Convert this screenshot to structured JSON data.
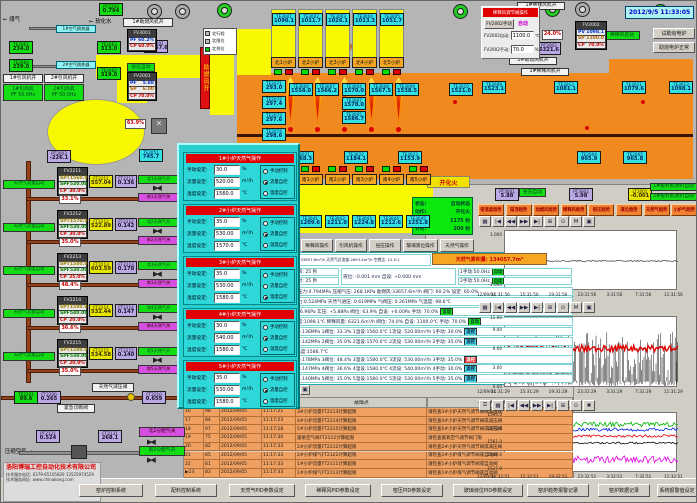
{
  "header": {
    "datetime": "2012/9/5 11:33:05"
  },
  "colors": {
    "furnace_orange": "#f08a1e",
    "duct_yellow": "#f8f800",
    "panel_cyan": "#27cfcf",
    "alarm_orange": "#f0a060",
    "pipe_brown": "#93401b",
    "status_green": "#0be80b",
    "alarm_red": "#e00000"
  },
  "ignite_label": "开化火",
  "accumulator": "天然气累积量: 134057.7m³",
  "company": {
    "name": "洛阳博瑞工控自动化技术有限公司",
    "phone": "技术服务电话: 0379-65105829  13525974529",
    "site": "技术服务网址: www.chinakong.com"
  },
  "status_box": {
    "rows": [
      [
        "状态:",
        "自动状态"
      ],
      [
        "动作:",
        "开化火"
      ],
      [
        "设定:",
        "1175 秒"
      ],
      [
        "计时:",
        "200 秒"
      ]
    ]
  },
  "legend": {
    "items": [
      {
        "color": "#c0c0c0",
        "text": "北行程"
      },
      {
        "color": "#c0c0c0",
        "text": "北限位"
      },
      {
        "color": "#00c000",
        "text": "北到位"
      }
    ]
  },
  "dilution_panel": {
    "title": "稀释风调节阀操作",
    "manual_button": "FV2002手动",
    "auto_label": "自动",
    "fields": [
      {
        "label": "FV2002自动:",
        "value": "1100.0",
        "unit": "℃"
      },
      {
        "label": "FV2002手动:",
        "value": "70.0",
        "unit": "%"
      }
    ]
  },
  "north_furnaces": [
    "北1小炉",
    "北2小炉",
    "北3小炉",
    "北4小炉",
    "北5小炉"
  ],
  "south_furnaces": [
    "南1小炉",
    "南2小炉",
    "南3小炉",
    "南4小炉",
    "南5小炉"
  ],
  "sensors": [
    {
      "id": "PT2202",
      "value": "0.794"
    },
    {
      "id": "TE2061",
      "value": "234.0"
    },
    {
      "id": "TE2064",
      "value": "239.0"
    },
    {
      "id": "TE2063",
      "value": "313.0"
    },
    {
      "id": "TE2062",
      "value": "319.0"
    },
    {
      "id": "FT2001",
      "value": "33657.6"
    },
    {
      "id": "PT2003",
      "value": "-226.1"
    },
    {
      "id": "TE2051",
      "value": "745.7"
    },
    {
      "id": "TE3001",
      "value": "1090.1"
    },
    {
      "id": "TE3002",
      "value": "1011.7"
    },
    {
      "id": "TE3003",
      "value": "1026.1"
    },
    {
      "id": "TE3004",
      "value": "1013.3"
    },
    {
      "id": "TE3005",
      "value": "1051.7"
    },
    {
      "id": "TE2071",
      "value": "293.0"
    },
    {
      "id": "TE2072",
      "value": "297.4"
    },
    {
      "id": "TE2073",
      "value": "297.6"
    },
    {
      "id": "TE2074",
      "value": "298.6"
    },
    {
      "id": "TE2075",
      "value": "298.6"
    },
    {
      "id": "TE3006",
      "value": "1558.0"
    },
    {
      "id": "TE3007",
      "value": "1566.2"
    },
    {
      "id": "TE3004",
      "value": "1570.0"
    },
    {
      "id": "TE3007",
      "value": "1578.0"
    },
    {
      "id": "TE3005",
      "value": "1586.7"
    },
    {
      "id": "TE3008",
      "value": "1567.5"
    },
    {
      "id": "TE3009",
      "value": "1538.5"
    },
    {
      "id": "TE3010",
      "value": "1521.0"
    },
    {
      "id": "TE3021",
      "value": "1168.3"
    },
    {
      "id": "TE3022",
      "value": "1184.1"
    },
    {
      "id": "TE3023",
      "value": "1153.9"
    },
    {
      "id": "TE2009",
      "value": "1523.1"
    },
    {
      "id": "TE3012",
      "value": "1081.1"
    },
    {
      "id": "TE3011",
      "value": "1079.6"
    },
    {
      "id": "TE3013",
      "value": "1098.1"
    },
    {
      "id": "TE2004",
      "value": "965.9"
    },
    {
      "id": "TE2005",
      "value": "965.8"
    },
    {
      "id": "TE3041",
      "value": "1209.6"
    },
    {
      "id": "TE3042",
      "value": "1211.0"
    },
    {
      "id": "TE3043",
      "value": "1224.8"
    },
    {
      "id": "TE3044",
      "value": "1212.6"
    },
    {
      "id": "TE3045",
      "value": "1251.8"
    },
    {
      "id": "PT3001",
      "value": "5.88"
    },
    {
      "id": "PT3002",
      "value": "5.98"
    },
    {
      "id": "LT2001",
      "value": "-0.001"
    },
    {
      "id": "PT2002",
      "value": "6321.6"
    },
    {
      "id": "TE2201",
      "value": "99.6"
    },
    {
      "id": "FT2200",
      "value": "0.265"
    },
    {
      "id": "FT2210",
      "value": "0.659"
    },
    {
      "id": "PT2121",
      "value": "0.524"
    },
    {
      "id": "FT2131",
      "value": "268.1"
    }
  ],
  "labels": [
    {
      "text": "← 煤气"
    },
    {
      "text": "← 软化水"
    },
    {
      "text": "1#空气换热器"
    },
    {
      "text": "2#空气换热器"
    },
    {
      "text": "1#引风机开"
    },
    {
      "text": "2#引风机开"
    },
    {
      "text": "1#助燃风机开"
    },
    {
      "text": "窑压自动"
    },
    {
      "text": "助燃风开"
    },
    {
      "text": "烟囱"
    },
    {
      "text": "蓄热室"
    },
    {
      "text": "蓄热室"
    },
    {
      "text": "1#稀释风机开"
    },
    {
      "text": "2#助燃风机开"
    },
    {
      "text": "1#稀释风机开"
    },
    {
      "text": "稀释风启动"
    },
    {
      "text": "窑压自动"
    },
    {
      "text": "1#投料机进料自动"
    },
    {
      "text": "2#投料机进料自动"
    },
    {
      "text": "天然气减压阀"
    },
    {
      "text": "紧急切断阀"
    },
    {
      "text": "北2分配气关"
    },
    {
      "text": "南2分配气开"
    },
    {
      "text": "压缩空气 →"
    },
    {
      "text": "63.9%"
    },
    {
      "text": "24.0%"
    },
    {
      "text": "1#引风机\nPF 50.0Hz"
    },
    {
      "text": "2#引风机\nPF 50.0Hz"
    }
  ],
  "controllers": [
    {
      "id": "FV3001",
      "rows": [
        {
          "k": "PF",
          "v": "60.2%",
          "c": "v-blue"
        },
        {
          "k": "CP",
          "v": "60.0%",
          "c": "v-red"
        }
      ]
    },
    {
      "id": "FV2001",
      "rows": [
        {
          "k": "PF",
          "v": "5.88",
          "c": "v-blue"
        },
        {
          "k": "SP",
          "v": "6.00",
          "c": "v-orange"
        },
        {
          "k": "CP",
          "v": "70.0%",
          "c": "v-red"
        }
      ]
    },
    {
      "id": "FV2002",
      "rows": [
        {
          "k": "PV",
          "v": "1098.1",
          "c": "v-blue"
        },
        {
          "k": "SP",
          "v": "1100.0",
          "c": "v-orange"
        },
        {
          "k": "CP",
          "v": "70.0%",
          "c": "v-red"
        }
      ]
    }
  ],
  "fuel_controllers": [
    {
      "id": "FV2211",
      "spt": "1560.0",
      "spf": "520.00",
      "cp": "30.0%",
      "flow_id": "FT2211",
      "flow": "557.04",
      "press_id": "FT2211",
      "press": "0.136",
      "pos": "33.1%",
      "open": "北1天然气开",
      "close": "南1天然气关",
      "mode": "天然气流量自动"
    },
    {
      "id": "FV2212",
      "spt": "1570.0",
      "spf": "530.00",
      "cp": "30.0%",
      "flow_id": "FT2212",
      "flow": "522.89",
      "press_id": "FT2212",
      "press": "0.142",
      "pos": "35.0%",
      "open": "北2天然气开",
      "close": "南2天然气关",
      "mode": "天然气流量自动"
    },
    {
      "id": "FV2213",
      "spt": "1580.0",
      "spf": "530.00",
      "cp": "25.0%",
      "flow_id": "FT2213",
      "flow": "603.59",
      "press_id": "FT2213",
      "press": "0.178",
      "pos": "48.4%",
      "open": "北3天然气开",
      "close": "南3天然气关",
      "mode": "天然气温度自动"
    },
    {
      "id": "FV2214",
      "spt": "1580.0",
      "spf": "540.00",
      "cp": "20.0%",
      "flow_id": "FT2214",
      "flow": "532.44",
      "press_id": "FT2214",
      "press": "0.147",
      "pos": "36.6%",
      "open": "北4天然气开",
      "close": "南4天然气关",
      "mode": "天然气流量自动"
    },
    {
      "id": "FV2215",
      "spt": "1580.0",
      "spf": "530.00",
      "cp": "20.0%",
      "flow_id": "FT2215",
      "flow": "534.58",
      "press_id": "FT2215",
      "press": "0.140",
      "pos": "35.0%",
      "open": "北5天然气开",
      "close": "南5天然气关",
      "mode": "天然气流量自动"
    }
  ],
  "popup": {
    "labels": {
      "manual": "手动设定:",
      "flow": "流量设定:",
      "temp": "温度设定:",
      "units": [
        "%",
        "m³/h",
        "℃"
      ],
      "radios": [
        "手动控制",
        "流量自控",
        "温度自控"
      ]
    },
    "sections": [
      {
        "title": "1#小炉天然气操作",
        "manual": "30.0",
        "flow": "520.00",
        "temp": "1560.0",
        "selected": 1
      },
      {
        "title": "2#小炉天然气操作",
        "manual": "35.0",
        "flow": "530.00",
        "temp": "1570.0",
        "selected": 1
      },
      {
        "title": "3#小炉天然气操作",
        "manual": "35.0",
        "flow": "530.00",
        "temp": "1580.0",
        "selected": 2
      },
      {
        "title": "4#小炉天然气操作",
        "manual": "30.0",
        "flow": "540.00",
        "temp": "1580.0",
        "selected": 1
      },
      {
        "title": "5#小炉天然气操作",
        "manual": "35.0",
        "flow": "530.00",
        "temp": "1580.0",
        "selected": 1
      }
    ]
  },
  "buttons": {
    "trend": [
      "窑温度趋势",
      "碹顶趋势",
      "助燃风趋势",
      "稀释风趋势",
      "窑压趋势",
      "液位趋势",
      "天然气趋势",
      "小炉气趋势"
    ],
    "operate": [
      "稀释风操作",
      "引风机操作",
      "窑压操作",
      "玻璃液位操作",
      "天然气操作"
    ],
    "right": [
      "试助熔电炉",
      "助熔电炉正常"
    ],
    "bottom": [
      "窑炉控制系统",
      "配料控制系统",
      "天然气PID参数设定",
      "稀释风PID参数设定",
      "窑压PID参数设定",
      "玻璃液位PID参数设定",
      "窑炉趋势报警记录",
      "窑炉数据记录",
      "系统报警值设定"
    ]
  },
  "params": {
    "rowA": "助燃风量:33657.6m³/h 天然气总流量:2693.4m³/h 空燃比: 12.5:1",
    "switch_time": [
      "换火时间: 25 秒",
      "换火计时: 25 秒"
    ],
    "level": "液位: -0.001 mm    自设: +0.000 mm",
    "fans": [
      [
        "1手动:50.0Hz",
        "自动"
      ],
      [
        "2手动:50.0Hz",
        "自动"
      ]
    ],
    "lines": [
      {
        "t": "天然气压力:0.794MPa  压缩气压: 268.1KPa  助燃风:33657.6m³/h  阀门: 60.2%  设定: 60.0%",
        "chip": null
      },
      {
        "t": "煤气压力:0.524MPa  天然气进压: 0.619MPa  气阀压: 0.261MPa  气温度: 98.6℃",
        "chip": null
      },
      {
        "t": "窑压: +6.96Pa  实压: +5.88Pa  阀位: 63.9%  自设: +6.00Pa  手动: 70.0%",
        "chip": "自动"
      },
      {
        "t": "稀释温度:1098.1℃  稀释风量: 6321.6m³/h  阀位: 74.0%  自设: 1100.0℃  手动: 70.0%",
        "chip": "自动"
      },
      {
        "t": "1压力:0.136MPa  1阀位: 33.3%  1温设:1560.0℃  1流设: 520.00m³/h  1手动: 30.0%",
        "chip": "流控"
      },
      {
        "t": "2压力:0.142MPa  2阀位: 35.0%  2温设:1570.0℃  2流设: 530.00m³/h  2手动: 35.0%",
        "chip": "流控"
      },
      {
        "t": "3碹顶温度:1586.7℃",
        "chip": null
      },
      {
        "t": "3压力:0.178MPa  3阀位: 48.4%  3温设:1580.0℃  3流设: 530.00m³/h  3手动: 35.0%",
        "chip": "温控"
      },
      {
        "t": "4压力:0.147MPa  4阀位: 36.6%  4温设:1580.0℃  4流设: 540.00m³/h  4手动: 30.0%",
        "chip": "流控"
      },
      {
        "t": "5压力:0.140MPa  5阀位: 35.0%  5温设:1580.0℃  5流设: 530.00m³/h  5手动: 35.0%",
        "chip": "流控"
      }
    ]
  },
  "alarm_table": {
    "headers": [
      "故障点",
      "故障原因（供参考）"
    ],
    "selected_seq": "23",
    "rows": [
      {
        "seq": "16",
        "code": "98",
        "date": "2012/09/05",
        "time": "11:17:21",
        "fault": "3#小炉流量FT2213计算超限",
        "reason": "请检查3#小炉天然气调节阀或减压阀"
      },
      {
        "seq": "17",
        "code": "84",
        "date": "2012/09/05",
        "time": "11:17:23",
        "fault": "4#小炉流量FT2214计算超限",
        "reason": "请检查4#小炉天然气调节阀或减压阀"
      },
      {
        "seq": "18",
        "code": "97",
        "date": "2012/09/05",
        "time": "11:17:28",
        "fault": "5#小炉流量FT2215计算超限",
        "reason": "请检查5#小炉天然气调节阀或减压阀"
      },
      {
        "seq": "19",
        "code": "75",
        "date": "2012/09/05",
        "time": "11:17:30",
        "fault": "富氧空气阀FT2112计算超限",
        "reason": "请检查富氧空气调节阀门限"
      },
      {
        "seq": "20",
        "code": "82",
        "date": "2012/09/05",
        "time": "11:17:33",
        "fault": "2#小炉流量FT2212计算超限",
        "reason": "请检查2#小炉天然气调节阀或减压阀"
      },
      {
        "seq": "21",
        "code": "85",
        "date": "2012/09/05",
        "time": "11:17:33",
        "fault": "2#小炉煤气FT2122计算超限",
        "reason": "请检查2#小炉煤气调节阀或自动阀"
      },
      {
        "seq": "22",
        "code": "81",
        "date": "2012/09/05",
        "time": "11:17:33",
        "fault": "1#小炉流量FT2111计算超限",
        "reason": "请检查1#小炉煤气调节阀或自动阀"
      },
      {
        "seq": "23",
        "code": "83",
        "date": "2012/09/05",
        "time": "11:17:33",
        "fault": "1#小炉煤气FT2113计算超限",
        "reason": "请检查1#小炉煤气调节阀或自动阀"
      }
    ]
  },
  "chart_data": [
    {
      "type": "line",
      "title": "",
      "ylim": [
        -1.2,
        1.2
      ],
      "yticks": [
        "1.000",
        "0.000",
        "-1.000"
      ],
      "ytick_vals": [
        1,
        0,
        -1
      ],
      "xticks": [
        "12/09/04",
        "11:31:56",
        "15:31:56",
        "19:31:56",
        "23:31:56",
        "3:31:56",
        "7:31:56",
        "11:31:56"
      ],
      "series": [
        {
          "name": "玻璃液位",
          "color": "#555555",
          "base": 0.0,
          "amp": 0.03,
          "style": "line",
          "width": 0.8
        }
      ],
      "toolbar": [
        "grid",
        "first",
        "rew",
        "fwd",
        "last",
        "print",
        "zoom",
        "mark",
        "save"
      ]
    },
    {
      "type": "line",
      "title": "",
      "ylim": [
        0,
        11.3
      ],
      "yticks": [
        "11.00",
        "9.00",
        "6.00",
        "3.00",
        "0.00"
      ],
      "ytick_vals": [
        11,
        9,
        6,
        3,
        0
      ],
      "xticks": [
        "12/09/04",
        "11:31:29",
        "15:31:29",
        "19:31:29",
        "23:31:29",
        "3:31:29",
        "7:31:29",
        "11:31:29"
      ],
      "series": [
        {
          "name": "窑压",
          "color": "#111111",
          "base": 4.6,
          "amp": 4.4,
          "style": "spikes",
          "width": 0.5
        },
        {
          "name": "窑压均线",
          "color": "#e00000",
          "base": 6.3,
          "amp": 0.55,
          "style": "line",
          "width": 1.4
        }
      ],
      "toolbar": [
        "grid",
        "first",
        "rew",
        "fwd",
        "last",
        "print",
        "zoom",
        "mark",
        "save"
      ]
    },
    {
      "type": "line",
      "title": "",
      "ylim": [
        1523,
        1599
      ],
      "yticks": [
        "1595.0",
        "1578.0",
        "1561.0",
        "1544.0",
        "1527.0"
      ],
      "ytick_vals": [
        1595,
        1578,
        1561,
        1544,
        1527
      ],
      "xticks": [
        "12/09/04",
        "11:32:51",
        "15:32:51",
        "19:32:51",
        "23:32:51",
        "3:32:51",
        "7:32:51",
        "11:32:51"
      ],
      "series": [
        {
          "name": "1#炉温",
          "color": "#00b400",
          "base": 1584.5,
          "amp": 3,
          "style": "line",
          "width": 0.8
        },
        {
          "name": "2#炉温",
          "color": "#0020e0",
          "base": 1578,
          "amp": 2,
          "style": "line",
          "width": 0.8
        },
        {
          "name": "3#炉温",
          "color": "#e00000",
          "base": 1570,
          "amp": 1.8,
          "style": "line",
          "width": 0.8
        },
        {
          "name": "4#炉温",
          "color": "#101010",
          "base": 1561,
          "amp": 1.2,
          "style": "line",
          "width": 0.8
        },
        {
          "name": "5#炉温",
          "color": "#e000e0",
          "base": 1540,
          "amp": 4.5,
          "style": "line",
          "width": 0.8
        }
      ],
      "toolbar": [
        "key",
        "grid",
        "first",
        "rew",
        "fwd",
        "last",
        "print",
        "zoom",
        "stop"
      ]
    }
  ],
  "alarm_toolbar": [
    "menu",
    "help",
    "view-a",
    "view-b",
    "view-c",
    "view-d",
    "report",
    "clock",
    "ascend",
    "ack",
    "lock"
  ]
}
